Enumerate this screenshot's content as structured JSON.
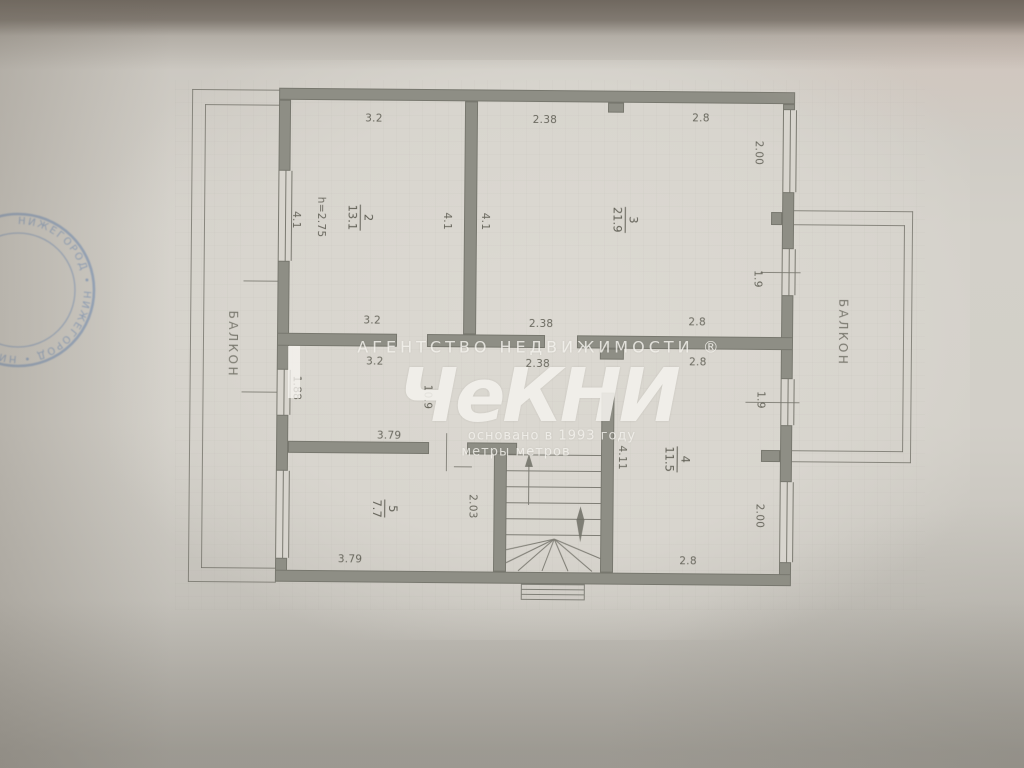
{
  "watermark": {
    "agency_line": "АГЕНТСТВО   НЕДВИЖИМОСТИ ®",
    "logo": "ЧеКНИ",
    "founded": "основано в 1993 году",
    "tagline": "метры метров"
  },
  "stamp": {
    "arc_text": "НИЖЕГОРОД • НИЖЕГОРОД • НИЖЕГОРОД • "
  },
  "labels": {
    "balcony_left": "БАЛКОН",
    "balcony_right": "БАЛКОН",
    "height_note": "h=2.75"
  },
  "rooms": {
    "room2": {
      "number": "2",
      "area": "13.1"
    },
    "room3": {
      "number": "3",
      "area": "21.9"
    },
    "room4": {
      "number": "4",
      "area": "11.5"
    },
    "room5": {
      "number": "5",
      "area": "7.7"
    },
    "corridor": {
      "area": "10.9"
    }
  },
  "dims": {
    "top_room2": "3.2",
    "top_room3_a": "2.38",
    "top_room3_b": "2.8",
    "mid_above_room2": "3.2",
    "mid_above_room3a": "2.38",
    "mid_above_room3b": "2.8",
    "mid_below_room2": "3.2",
    "mid_below_a": "2.38",
    "mid_below_b": "2.8",
    "room5_top": "3.79",
    "room5_bottom": "3.79",
    "room4_bottom": "2.8",
    "left_wall_room2": "4.1",
    "room2_right": "4.1",
    "room3_left": "4.1",
    "right_wall_top": "2.00",
    "right_wall_mid": "1.9",
    "left_wall_mid": "1.88",
    "room5_right": "2.03",
    "stair_wall": "4.11",
    "room4_right_top": "1.9",
    "room4_right_bottom": "2.00"
  },
  "colors": {
    "wall": "#8e8e85",
    "ink": "#5c5b51",
    "stamp_blue": "#5d81b6",
    "paper": "#d9d6cf"
  }
}
